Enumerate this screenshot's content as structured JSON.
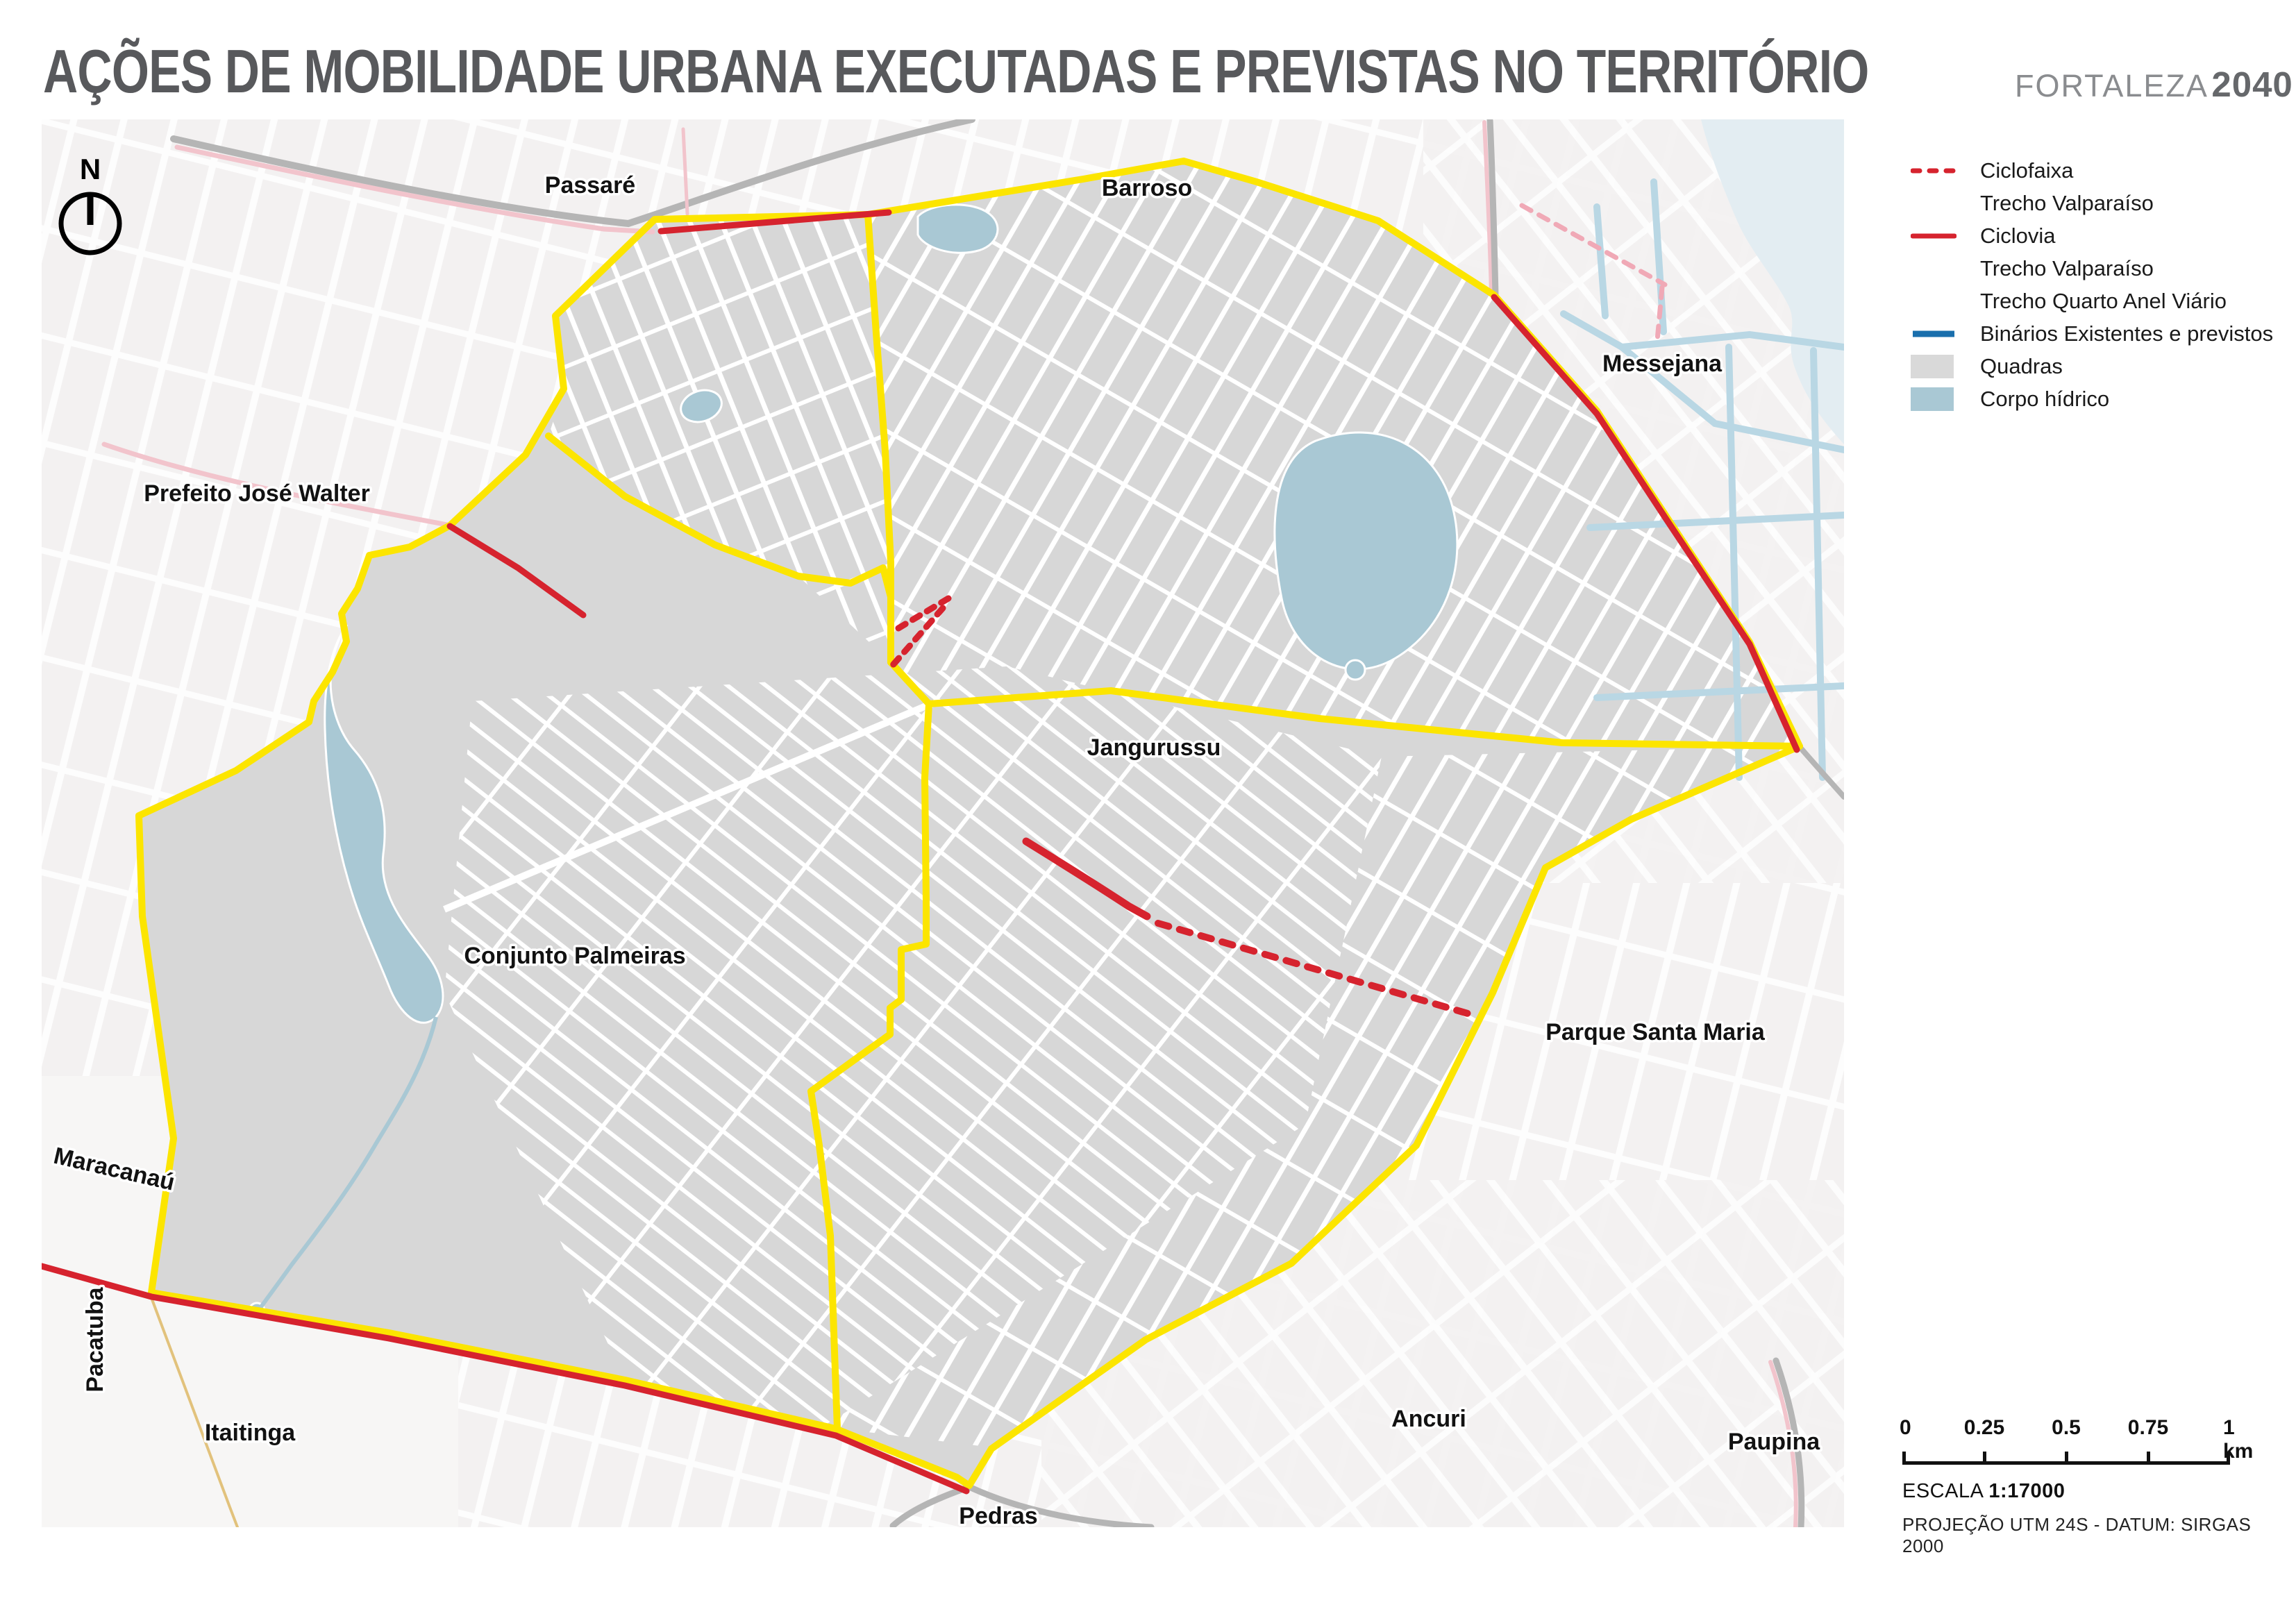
{
  "header": {
    "title": "AÇÕES DE MOBILIDADE URBANA EXECUTADAS E PREVISTAS NO TERRITÓRIO",
    "brand_name": "FORTALEZA",
    "brand_year": "2040"
  },
  "north_indicator": {
    "label": "N"
  },
  "legend": {
    "items": [
      {
        "symbol": "ciclofaixa-dashed-red-line",
        "label": "Ciclofaixa"
      },
      {
        "symbol": "none",
        "label": "Trecho Valparaíso"
      },
      {
        "symbol": "ciclovia-solid-red-line",
        "label": "Ciclovia"
      },
      {
        "symbol": "none",
        "label": "Trecho Valparaíso"
      },
      {
        "symbol": "none",
        "label": "Trecho Quarto Anel Viário"
      },
      {
        "symbol": "binarios-solid-blue-line",
        "label": "Binários Existentes e previstos"
      },
      {
        "symbol": "quadras-gray-swatch",
        "label": "Quadras"
      },
      {
        "symbol": "corpo-hidrico-blue-swatch",
        "label": "Corpo hídrico"
      }
    ]
  },
  "map": {
    "labels": [
      {
        "id": "passare",
        "text": "Passaré"
      },
      {
        "id": "barroso",
        "text": "Barroso"
      },
      {
        "id": "prefeito-jose-walter",
        "text": "Prefeito José Walter"
      },
      {
        "id": "messejana",
        "text": "Messejana"
      },
      {
        "id": "jangurussu",
        "text": "Jangurussu"
      },
      {
        "id": "conjunto-palmeiras",
        "text": "Conjunto Palmeiras"
      },
      {
        "id": "parque-santa-maria",
        "text": "Parque Santa Maria"
      },
      {
        "id": "maracanau",
        "text": "Maracanaú"
      },
      {
        "id": "pacatuba",
        "text": "Pacatuba"
      },
      {
        "id": "itaitinga",
        "text": "Itaitinga"
      },
      {
        "id": "ancuri",
        "text": "Ancuri"
      },
      {
        "id": "paupina",
        "text": "Paupina"
      },
      {
        "id": "pedras",
        "text": "Pedras"
      }
    ]
  },
  "scalebar": {
    "ticks": [
      "0",
      "0.25",
      "0.5",
      "0.75",
      "1 km"
    ],
    "escala_label": "ESCALA",
    "escala_value": "1:17000",
    "projecao": "PROJEÇÃO UTM 24S - DATUM: SIRGAS 2000"
  },
  "colors": {
    "boundary_yellow": "#FCE500",
    "ciclovia_red": "#D6232E",
    "ciclofaixa_red_dashed": "#D6232E",
    "binarios_blue": "#1A6FAD",
    "quadras_gray": "#D7D7D7",
    "corpo_hidrico_blue": "#A9C8D4",
    "existing_bike_pink": "#F2C4CC",
    "highway_gray": "#B5B5B5"
  }
}
